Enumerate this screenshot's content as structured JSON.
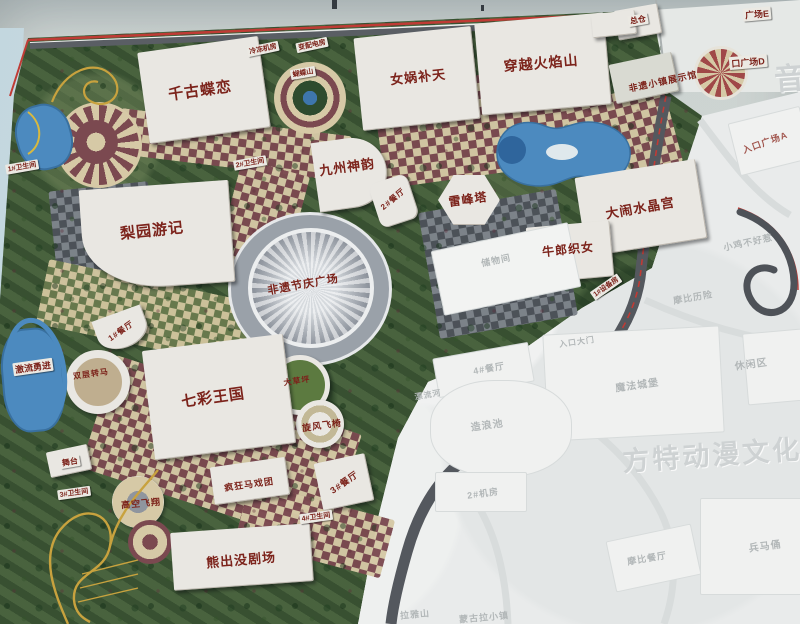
{
  "map_type": "theme-park-masterplan-photo",
  "colors": {
    "label_red": "#7c231b",
    "path_maroon": "#7b4950",
    "path_tan": "#d6c9a6",
    "greenery": "#46603c",
    "water_blue": "#4c8abf",
    "road_red": "#c03b35",
    "coaster_gold": "#c8a23e",
    "faded_grey": "#e9ebeb",
    "ghost_text": "#b2b7b8"
  },
  "labels": {
    "butterfly": "千古蝶恋",
    "nvwa": "女娲补天",
    "flame": "穿越火焰山",
    "zongcang": "总仓",
    "jiuzhou": "九州神韵",
    "rest2": "2#餐厅",
    "leifeng": "雷峰塔",
    "liyuan": "梨园游记",
    "crystal": "大闹水晶宫",
    "cowherd": "牛郎织女",
    "feiyi_plaza": "非遗节庆广场",
    "rainbow": "七彩王国",
    "bear": "熊出没剧场",
    "circus": "疯狂马戏团",
    "skyfly": "高空飞翔",
    "windchair": "旋风飞椅",
    "lawn": "大草坪",
    "carousel": "双层转马",
    "flume": "激流勇进",
    "stage": "舞台",
    "rest1": "1#餐厅",
    "rest3": "3#餐厅",
    "heritage_hall": "非遗小镇展示馆",
    "butterfly_hill": "蝴蝶山",
    "chiller": "冷冻机房",
    "power": "变配电房",
    "equip1": "1#设备房",
    "wc1": "1#卫生间",
    "wc2": "2#卫生间",
    "wc3": "3#卫生间",
    "wc4": "4#卫生间",
    "plazaE": "广场E",
    "plazaD": "口广场D",
    "plazaA": "入口广场A"
  },
  "faded_labels": {
    "storage": "储物间",
    "rest4": "4#餐厅",
    "river": "漂流河",
    "wavepool": "造浪池",
    "mach2": "2#机房",
    "gate": "入口大门",
    "castle": "魔法城堡",
    "leisure": "休闲区",
    "chicken": "小鸡不好惹",
    "mobi": "摩比历险",
    "mobirest": "摩比餐厅",
    "terracotta": "兵马俑",
    "mountain": "拉雅山",
    "town": "蒙古拉小镇"
  },
  "watermarks": {
    "brand": "方特动漫文化科技",
    "corner": "音"
  }
}
